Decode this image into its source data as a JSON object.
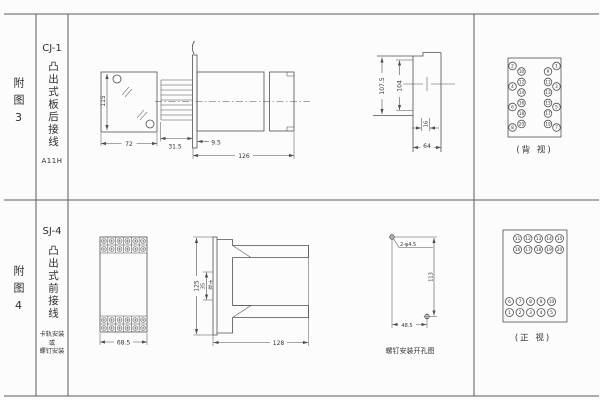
{
  "sheet": {
    "bg": "#fcfcfc",
    "line_color": "#4f4f4f",
    "text_color": "#333333"
  },
  "figure3": {
    "row_label": "附图3",
    "model": "CJ-1",
    "mount_type": "凸出式板后接线",
    "code": "A11H",
    "front_view": {
      "height_dim": "115",
      "width_dim": "72"
    },
    "side_view": {
      "flange_offset_dim": "9.5",
      "pin_section_dim": "31.5",
      "length_dim": "126"
    },
    "cutout_view": {
      "outer_height_dim": "107.5",
      "inner_height_dim": "104",
      "slot_dim": "16",
      "width_dim": "64"
    },
    "back_view": {
      "caption": "(背 视)",
      "left_outer": [
        "2",
        "4",
        "6",
        "8"
      ],
      "left_inner": [
        "10",
        "12",
        "14",
        "16",
        "18",
        "20"
      ],
      "right_inner": [
        "9",
        "11",
        "13",
        "15",
        "17",
        "19"
      ],
      "right_outer": [
        "1",
        "3",
        "5",
        "7"
      ]
    }
  },
  "figure4": {
    "row_label": "附图4",
    "model": "SJ-4",
    "mount_type": "凸出式前接线",
    "install_note": [
      "卡轨安装",
      "或",
      "螺钉安装"
    ],
    "front_view": {
      "width_dim": "68.5"
    },
    "side_view": {
      "height_dim": "125",
      "rail_dim": "35",
      "rail_label": "卡轨",
      "depth_dim": "128"
    },
    "drill_view": {
      "holes_label": "2-φ4.5",
      "height_dim": "113",
      "width_dim": "48.5",
      "caption": "螺钉安装开孔图"
    },
    "front_terminal_view": {
      "caption": "(正 视)",
      "rows": [
        [
          "11",
          "12",
          "13",
          "14",
          "15"
        ],
        [
          "16",
          "17",
          "18",
          "19",
          "20"
        ],
        [
          "6",
          "7",
          "8",
          "9",
          "10"
        ],
        [
          "1",
          "2",
          "3",
          "4",
          "5"
        ]
      ]
    }
  }
}
